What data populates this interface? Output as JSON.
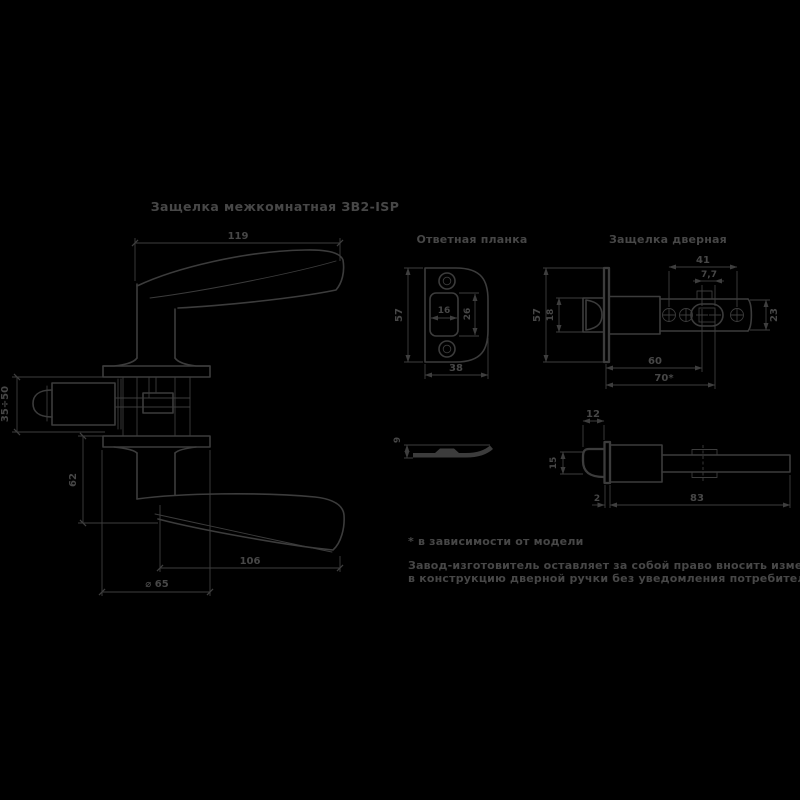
{
  "title": "Защелка межкомнатная ЗВ2-ISP",
  "labels": {
    "strike_plate": "Ответная планка",
    "latch": "Защелка дверная"
  },
  "handle_view": {
    "dim_width": "119",
    "dim_backset": "35÷50",
    "dim_offset": "62",
    "dim_lever": "106",
    "dim_diameter": "⌀ 65"
  },
  "strike_front": {
    "dim_height": "57",
    "dim_slot_w": "16",
    "dim_slot_h": "26",
    "dim_width": "38"
  },
  "strike_side": {
    "dim_height": "9"
  },
  "latch_front": {
    "dim_plate_height": "57",
    "dim_bolt": "18",
    "dim_span": "41",
    "dim_gap": "7,7",
    "dim_tube": "23",
    "dim_60": "60",
    "dim_70": "70*"
  },
  "latch_side": {
    "dim_throw": "12",
    "dim_bolt_w": "15",
    "dim_plate_t": "2",
    "dim_length": "83"
  },
  "notes": {
    "footnote": "* в зависимости от модели",
    "disclaimer1": "Завод-изготовитель оставляет за собой право вносить изменения",
    "disclaimer2": "в конструкцию дверной ручки без уведомления потребителя."
  },
  "colors": {
    "background": "#000000",
    "line": "#3c3c3c",
    "text": "#474747"
  }
}
